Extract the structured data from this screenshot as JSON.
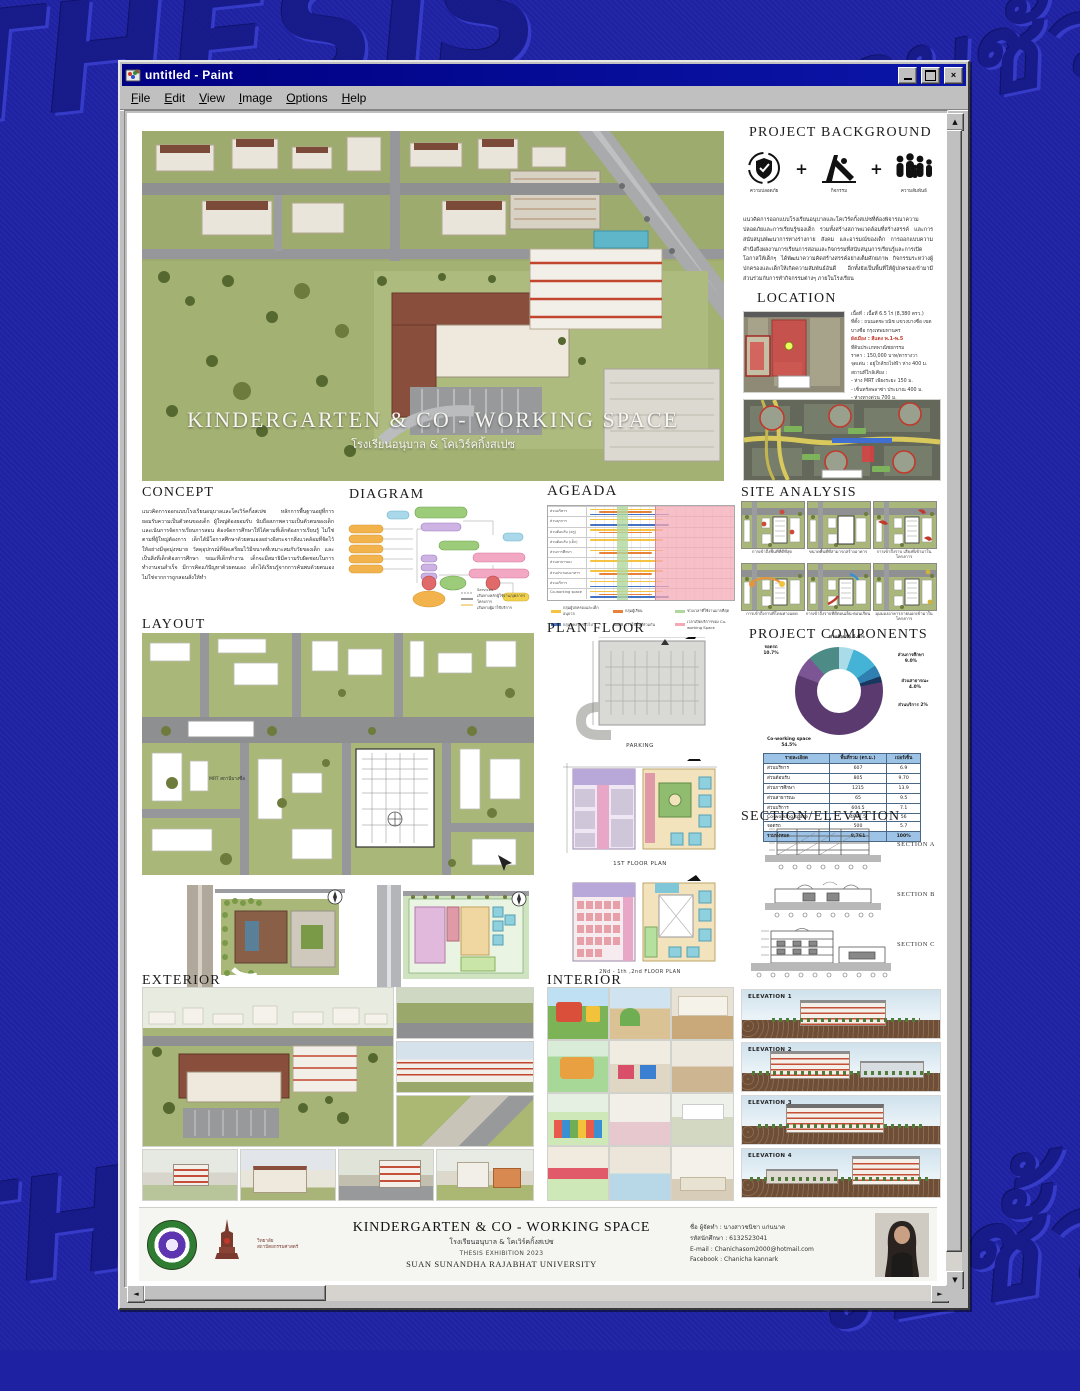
{
  "desktop": {
    "watermarks": [
      "THESIS",
      "จบชั้ว!",
      "THESIS",
      "จบชั้ว!"
    ]
  },
  "window": {
    "title": "untitled - Paint",
    "menus": [
      "File",
      "Edit",
      "View",
      "Image",
      "Options",
      "Help"
    ],
    "controls": {
      "minimize": "_",
      "maximize": "",
      "close": "×"
    }
  },
  "poster": {
    "hero": {
      "title": "KINDERGARTEN & CO - WORKING SPACE",
      "subtitle": "โรงเรียนอนุบาล & โคเวิร์คกิ้งสเปซ"
    },
    "project_background": {
      "heading": "PROJECT BACKGROUND",
      "plus": "+",
      "icons": [
        {
          "caption": "ความปลอดภัย"
        },
        {
          "caption": "กิจกรรม"
        },
        {
          "caption": "ความสัมพันธ์"
        }
      ],
      "paragraph": "แนวคิดการออกแบบโรงเรียนอนุบาลและโคเวิร์คกิ้งสเปซที่ต้องพิจารณาความปลอดภัยและการเรียนรู้ของเด็ก รวมทั้งสร้างสภาพแวดล้อมที่สร้างสรรค์ และการสนับสนุนพัฒนาการทางร่างกาย สังคม และอารมณ์ของเด็ก การออกแบบความคำนึงถึงผลงานการเรียนการสอนและกิจกรรมที่สนับสนุนการเรียนรู้และการเปิดโอกาสให้เด็กๆ ได้พัฒนาความคิดสร้างสรรค์อย่างเต็มศักยภาพ กิจกรรมระหว่างผู้ปกครองและเด็กให้เกิดความสัมพันธ์อันดี อีกทั้งยังเป็นพื้นที่ให้ผู้ปกครองเข้ามามีส่วนร่วมกับการทำกิจกรรมต่างๆ ภายในโรงเรียน"
    },
    "location": {
      "heading": "LOCATION",
      "area_line": "เนื้อที่ : เนื้อที่ 6.5 ไร่ (8,380 ตรว.)",
      "site_line": "ที่ตั้ง : ถนนเตชะวณิช แขวงบางซื่อ เขตบางซื่อ กรุงเทพมหานคร",
      "zoning_label": "ผังเมือง : สีแดง พ.1-พ.5",
      "zoning_detail": "ที่ดินประเภทพาณิชยกรรม",
      "price_line": "ราคา : 150,000 บาท/ตารางวา",
      "highlight_line": "จุดเด่น : อยู่ใกล้รถไฟฟ้า ห่าง 400 ม.",
      "nearby_label": "สถานที่ใกล้เคียง :",
      "nearby": [
        "- ห่าง MRT เพียงระยะ 150 ม.",
        "- เซ็นทรัลพลาซ่า ประมาณ 400 ม.",
        "- ห่างทางด่วน 700 ม.",
        "- MRT สายสีน้ำเงิน-สีแดง ประมาณ 1 กม."
      ]
    },
    "site_analysis": {
      "heading": "SITE ANALYSIS",
      "items": [
        {
          "caption": "การเข้าถึงพื้นที่ที่ดีที่สุด"
        },
        {
          "caption": "ขนาดพื้นที่ที่สามารถสร้างอาคาร"
        },
        {
          "caption": "การเข้าถึงราบ เสียงที่เข้ามาในโครงการ"
        },
        {
          "caption": "การเข้าถึงราบที่โดนทางแดด"
        },
        {
          "caption": "การเข้าถึงราบที่ดีตอนเย็น-ตอนเรียน"
        },
        {
          "caption": "มุมมองอาคารภายนอกเข้ามาในโครงการ"
        }
      ]
    },
    "project_components": {
      "heading": "PROJECT COMPONENTS",
      "chart_data": {
        "type": "pie",
        "title": "PROJECT COMPONENTS",
        "segments": [
          {
            "label": "ส่วนต้อนรับ",
            "pct": "5.0%",
            "value": 5.0,
            "color": "#a9dbe8"
          },
          {
            "label": "ส่วนการศึกษา",
            "pct": "9.0%",
            "value": 9.0,
            "color": "#45b3d6"
          },
          {
            "label": "ส่วนสาธารณะ",
            "pct": "4.0%",
            "value": 4.0,
            "color": "#2f7fb0"
          },
          {
            "label": "ส่วนบริการ",
            "pct": "2%",
            "value": 2.0,
            "color": "#17375e"
          },
          {
            "label": "Co-working space",
            "pct": "54.5%",
            "value": 54.5,
            "color": "#5b3a70"
          },
          {
            "label": "ส่วนบริหาร",
            "pct": "6.9%",
            "value": 6.9,
            "color": "#7c5694"
          },
          {
            "label": "จอดรถ",
            "pct": "10.7%",
            "value": 10.7,
            "color": "#4d8b86"
          }
        ]
      },
      "table": {
        "headers": [
          "รายละเอียด",
          "พื้นที่รวม (ตร.ม.)",
          "เปอร์เซ็น"
        ],
        "rows": [
          [
            "ส่วนบริหาร",
            "607",
            "6.9"
          ],
          [
            "ส่วนต้อนรับ",
            "805",
            "9.70"
          ],
          [
            "ส่วนการศึกษา",
            "1215",
            "13.9"
          ],
          [
            "ส่วนสาธารณะ",
            "65",
            "9.5"
          ],
          [
            "ส่วนบริการ",
            "604.5",
            "7.1"
          ],
          [
            "Co-working space",
            "4907.5",
            "56"
          ],
          [
            "จอดรถ",
            "500",
            "5.7"
          ]
        ],
        "total_row": [
          "รวมทั้งหมด",
          "8,761",
          "100%"
        ]
      }
    },
    "section_elevation": {
      "heading": "SECTION/ELEVATION",
      "labels": [
        "SECTION A",
        "SECTION B",
        "SECTION C"
      ]
    },
    "elevations": {
      "labels": [
        "ELEVATION 1",
        "ELEVATION 2",
        "ELEVATION 3",
        "ELEVATION 4"
      ]
    },
    "concept": {
      "heading": "CONCEPT",
      "paragraph": "แนวคิดการออกแบบโรงเรียนอนุบาลและโคเวิร์คกิ้งสเปซ หลักการพื้นฐานอยู่ที่การยอมรับความเป็นตัวตนของเด็ก ผู้ใหญ่ต้องยอมรับ นับถือสภาพความเป็นตัวตนของเด็ก และเน้นการจัดการเรียนการสอน ต้องจัดการศึกษาให้ได้ตามที่เด็กต้องการเรียนรู้ ไม่ใช่ตามที่ผู้ใหญ่ต้องการ เด็กได้มีโอกาสศึกษาด้วยตนเองอย่างอิสระจากสิ่งแวดล้อมที่จัดไว้ให้อย่างมีจุดมุ่งหมาย วัสดุอุปกรณ์ที่จัดเตรียมไว้มีขนาดที่เหมาะสมกับวัยของเด็ก และเป็นสิ่งที่เด็กต้องการศึกษา ขณะที่เด็กทำงาน เด็กจะมีสมาธิมีความรับผิดชอบในการทำงานจนสำเร็จ มีการคิดแก้ปัญหาด้วยตนเอง เด็กได้เรียนรู้จากการค้นพบด้วยตนเอง ไม่ใช่จากการถูกสอนสั่งให้ทำ"
    },
    "diagram": {
      "heading": "DIAGRAM",
      "legend": [
        "Services",
        "เส้นทางหลักผู้ใช้งาน/บุคลากรโครงการ",
        "เส้นทางผู้มาใช้บริการ"
      ]
    },
    "agenda": {
      "heading": "AGEADA",
      "rows": [
        "ส่วนบริหาร",
        "ส่วนธุรการ",
        "ส่วนต้อนรับ (ครู)",
        "ส่วนต้อนรับ (เด็ก)",
        "ส่วนการศึกษา",
        "ส่วนสาธารณะ",
        "ส่วนประกอบอาหาร",
        "ส่วนบริการ",
        "Co-working space"
      ],
      "legend": [
        {
          "label": "กลุ่มผู้ปกครองและเด็กอนุบาล",
          "color": "#f5c242"
        },
        {
          "label": "กลุ่มผู้เรียน",
          "color": "#e8823a"
        },
        {
          "label": "ช่วงเวลาที่ใช้งานมากที่สุด",
          "color": "#b0d7a0"
        },
        {
          "label": "กลุ่มบุคลากรทั่วไป",
          "color": "#4472c4"
        },
        {
          "label": "การใช้พื้นที่ร่วมกัน",
          "color": "#aaaaaa"
        },
        {
          "label": "เวลาเปิดบริการของ Co-working Space",
          "color": "#f4a9b4"
        }
      ]
    },
    "layout": {
      "heading": "LAYOUT",
      "mrt_label": "MRT สถานีบางซื่อ"
    },
    "plan_floor": {
      "heading": "PLAN FLOOR",
      "captions": [
        "PARKING",
        "1ST FLOOR PLAN",
        "2Nd - 1th ,2nd FLOOR PLAN"
      ]
    },
    "exterior": {
      "heading": "EXTERIOR"
    },
    "interior": {
      "heading": "INTERIOR"
    },
    "footer": {
      "title": "KINDERGARTEN & CO - WORKING SPACE",
      "subtitle": "โรงเรียนอนุบาล & โคเวิร์คกิ้งสเปซ",
      "exhibition": "THESIS EXHIBITION 2023",
      "university": "SUAN SUNANDHA RAJABHAT UNIVERSITY",
      "college": "วิทยาลัยสถาปัตยกรรมศาสตร์",
      "info": [
        "ชื่อ ผู้จัดทำ : นางสาวชนิชา แก่นนาค",
        "รหัสนักศึกษา : 6132523041",
        "E-mail : Chanichasom2000@hotmail.com",
        "Facebook : Chanicha kannark"
      ]
    }
  }
}
